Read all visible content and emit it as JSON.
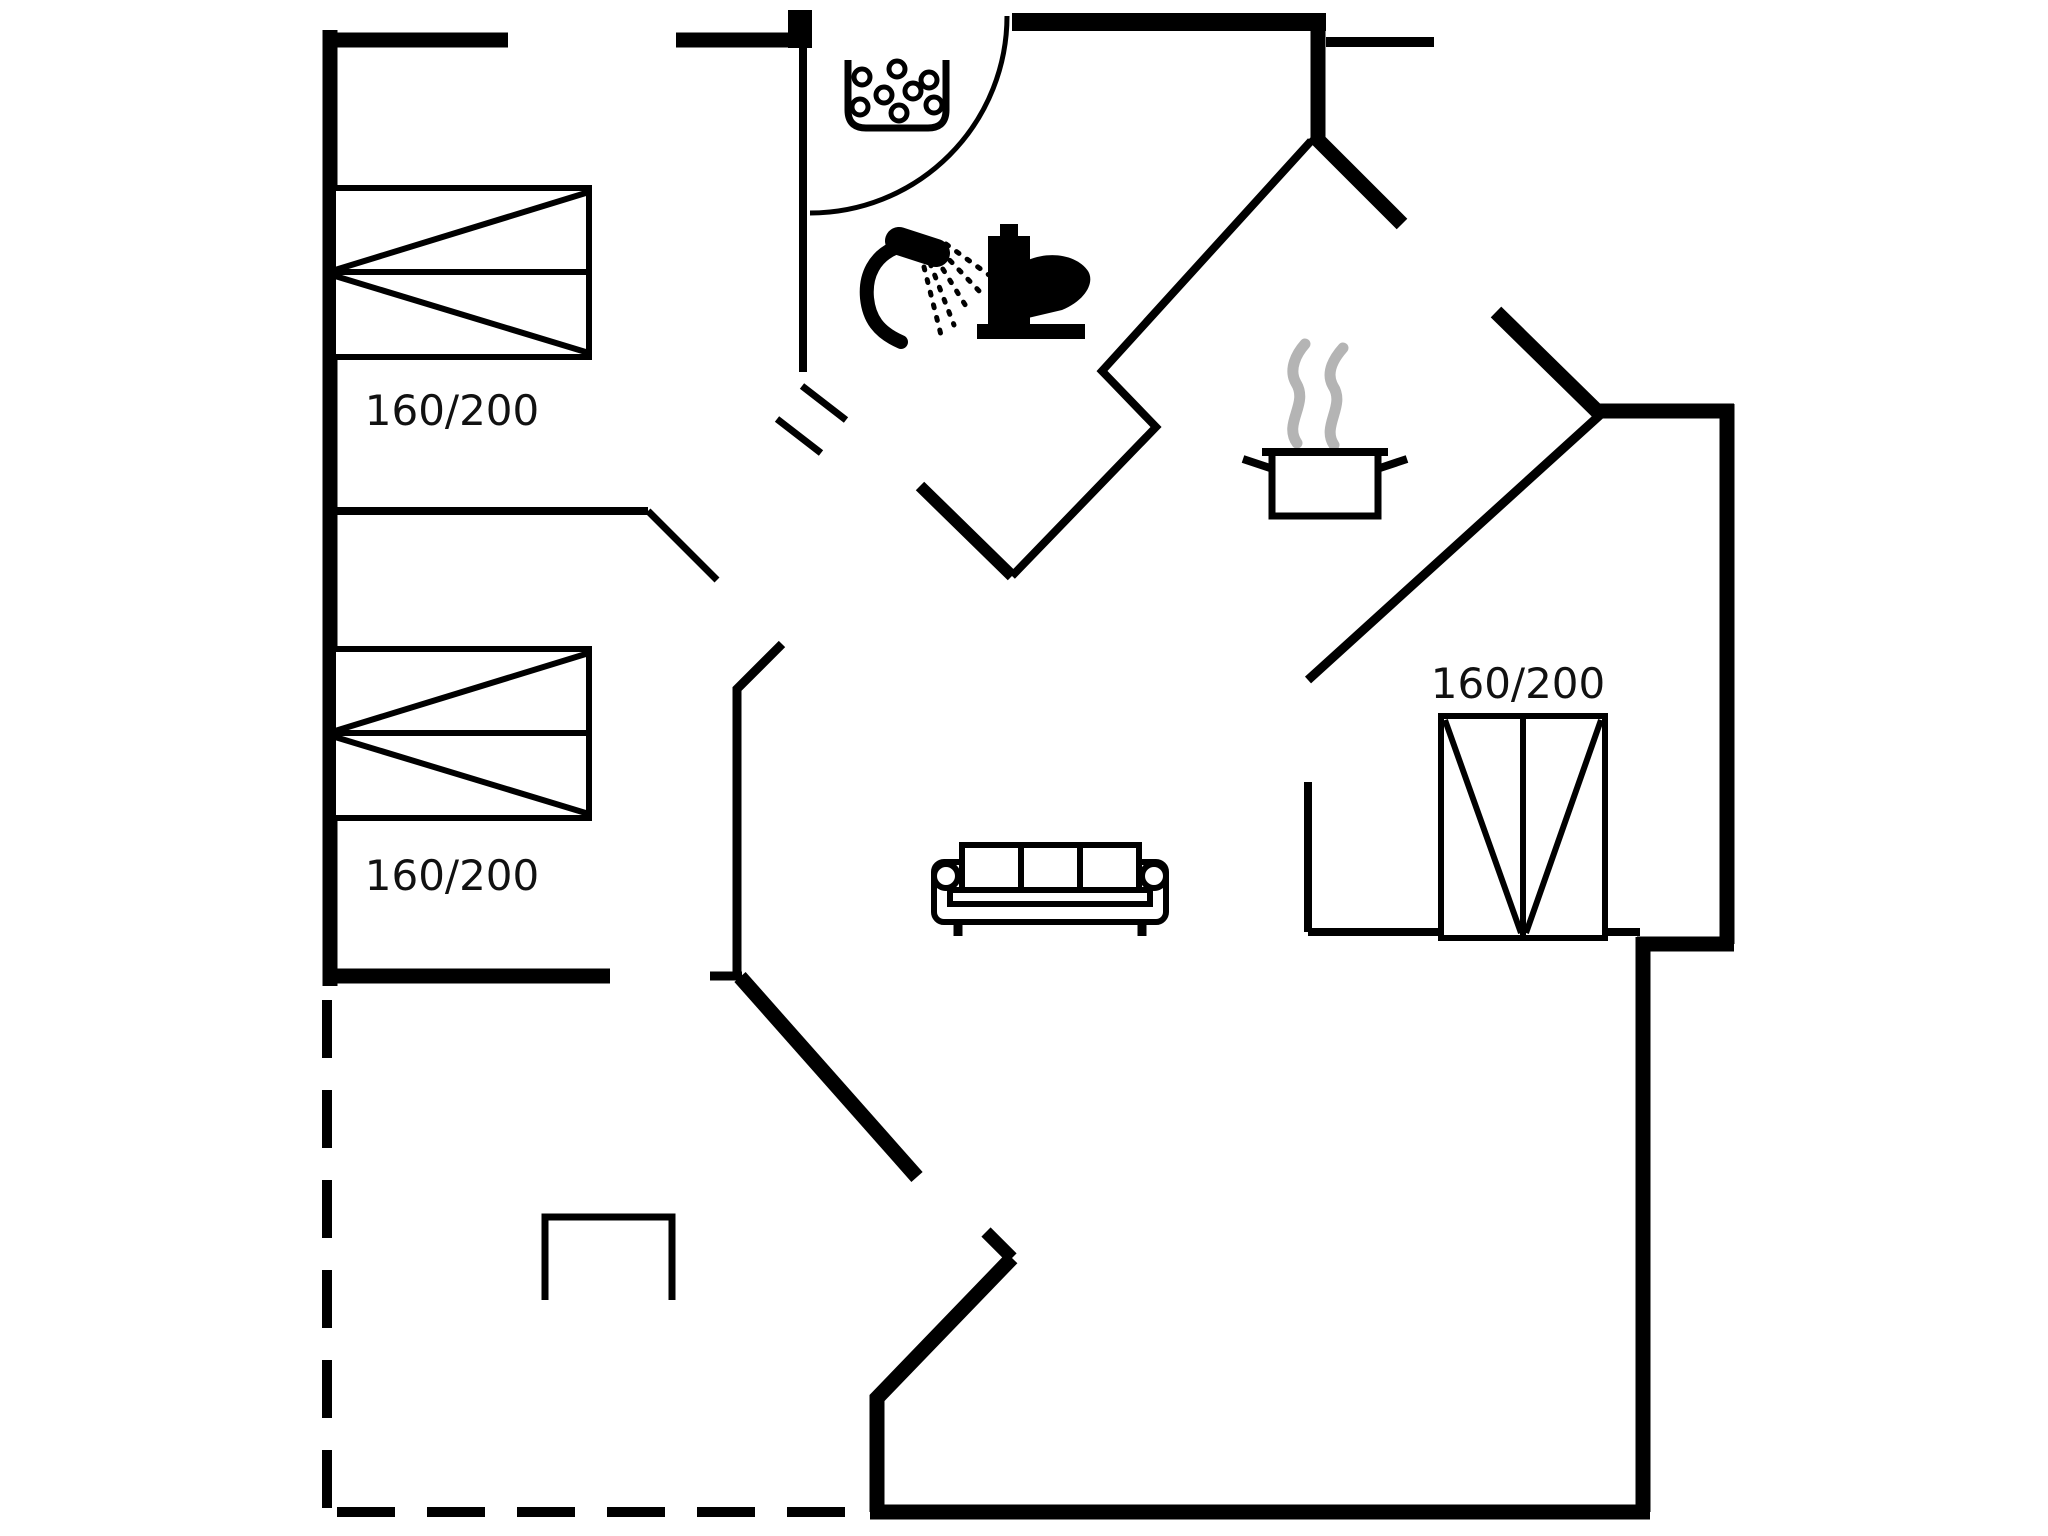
{
  "document": {
    "type": "floor-plan",
    "description": "black and white architectural floor plan of a holiday house"
  },
  "colors": {
    "wall": "#000000",
    "background": "#ffffff",
    "steam": "#b4b4b4",
    "label": "#111111"
  },
  "beds": [
    {
      "id": "bed-top-left",
      "label": "160/200"
    },
    {
      "id": "bed-middle-left",
      "label": "160/200"
    },
    {
      "id": "bed-right",
      "label": "160/200"
    }
  ],
  "icons": [
    "washbasin-icon",
    "shower-icon",
    "toilet-icon",
    "cooking-pot-icon",
    "steam-icon",
    "sofa-icon",
    "double-bed-icon",
    "door-swing-icon",
    "fireplace-icon",
    "terrace-dashed-outline"
  ]
}
